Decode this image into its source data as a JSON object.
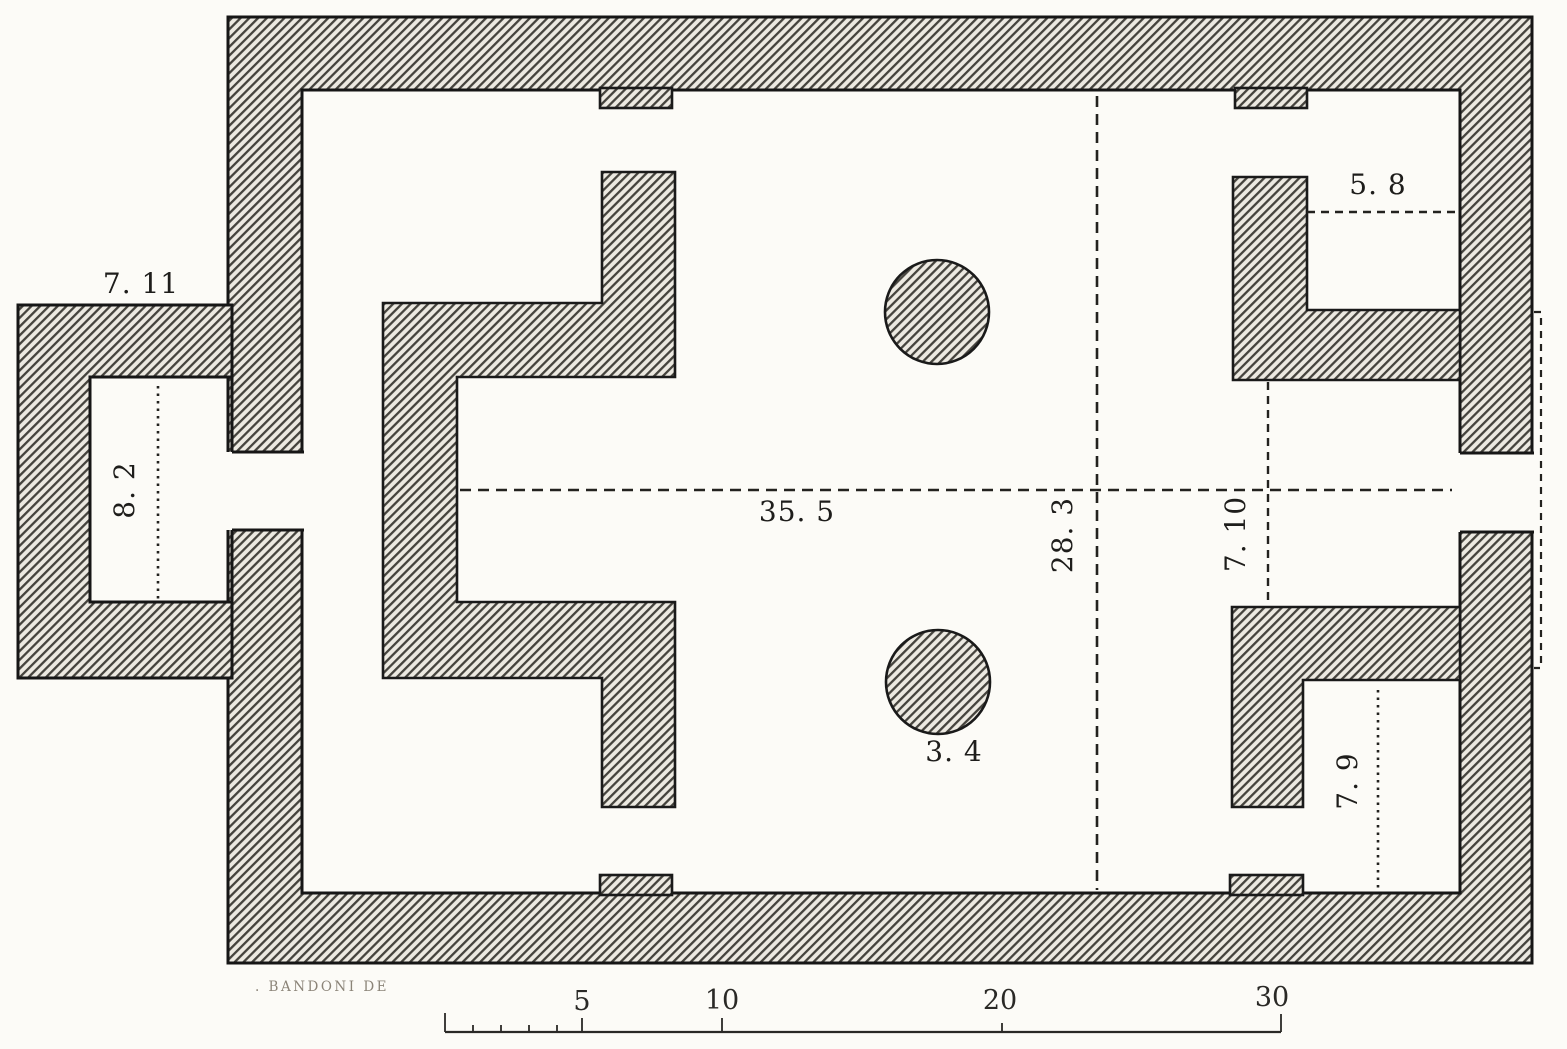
{
  "page": {
    "type": "engraved architectural floor plan",
    "paper_color": "#fcfbf7",
    "ink_color": "#161616",
    "hatch_line_color": "#45433d",
    "hatch_bg_color": "#ece9e1"
  },
  "plan": {
    "dimension_labels": {
      "annex_width": "7. 11",
      "annex_room": "8. 2",
      "nave_length": "35. 5",
      "nave_width": "28. 3",
      "east_bay": "7. 10",
      "northeast_room": "5. 8",
      "southeast_room": "7. 9",
      "column": "3. 4"
    }
  },
  "scale_bar": {
    "tick_labels": [
      "5",
      "10",
      "20",
      "30"
    ]
  },
  "credit_text": ". BANDONI DE"
}
